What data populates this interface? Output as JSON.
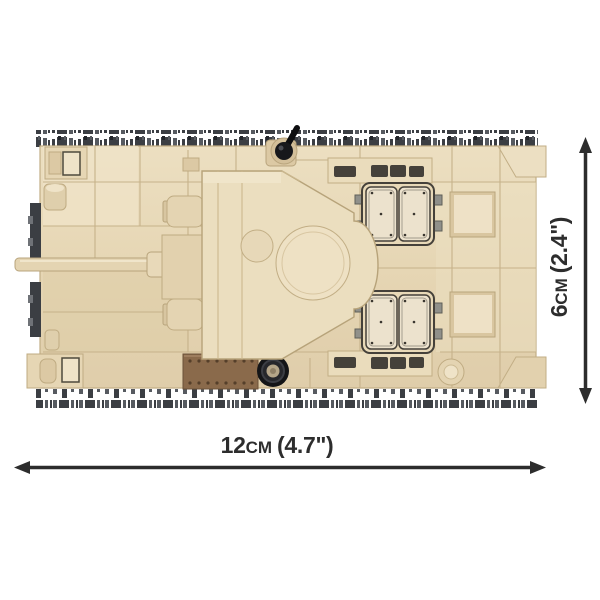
{
  "dimensions": {
    "width": {
      "value": "12",
      "unit": "cm",
      "inches": "(4.7\")",
      "full_label": "12cm (4.7\")"
    },
    "height": {
      "value": "6",
      "unit": "cm",
      "inches": "(2.4\")",
      "full_label": "6cm (2.4\")"
    }
  },
  "colors": {
    "background": "#ffffff",
    "dimension_lines_and_text": "#2d2d2d",
    "brick_tan": "#e6d6b4",
    "brick_tan_light": "#eee1c6",
    "brick_tan_dark": "#d8c6a1",
    "seam_line": "#c6b28a",
    "track_gray_dark": "#3b3e43",
    "track_gray_mid": "#6f7277",
    "access_plate_brown": "#8a6a4b",
    "hatch_outline": "#45413a",
    "wheel_black": "#17181b"
  }
}
